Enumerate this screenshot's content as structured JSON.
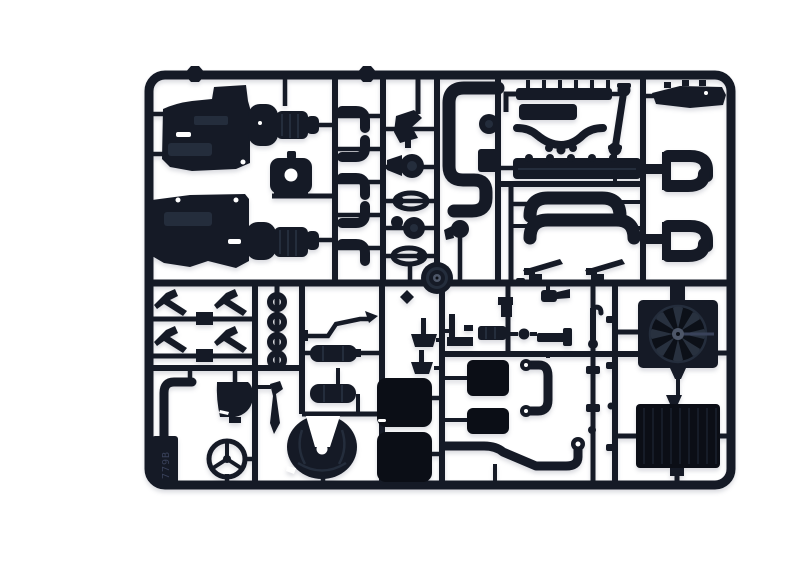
{
  "photo": {
    "alt": "Product photograph of a black injection-moulded plastic model-kit sprue (parts tree) on a white background, containing truck engine, exhaust, radiator and cab detail parts",
    "tag_text": "779B"
  },
  "colors": {
    "background": "#ffffff",
    "plastic": "#151a26",
    "plastic-dark": "#0b0e16",
    "plastic-mid": "#242d3c",
    "plastic-light": "#3a4356",
    "hub": "#4d5668",
    "emboss": "#39415a"
  },
  "parts": [
    "engine block half upper",
    "engine block half lower",
    "gearbox housings",
    "engine mount bracket",
    "hose elbows x5",
    "belt and pulley set",
    "crankshaft pulley",
    "intake S-pipe",
    "water pump",
    "junction box",
    "auxiliary pump",
    "injector rail",
    "valve cover",
    "exhaust manifold",
    "cylinder head",
    "drive shaft",
    "silencer pipes x2",
    "foot pedals x2",
    "chassis cross member",
    "exhaust elbow pairs x2",
    "wiper arms x4",
    "sealing rings x4",
    "brake line",
    "air tanks x2",
    "exhaust downpipe",
    "cab corner panel",
    "gear lever",
    "steering wheel",
    "fifth wheel coupling",
    "seat cushions x2",
    "mounting brackets",
    "engine pads x2",
    "coolant hose loop",
    "flexible exhaust pipe",
    "linkage parts",
    "radiator fan with shroud",
    "radiator core",
    "sprue id tag"
  ]
}
